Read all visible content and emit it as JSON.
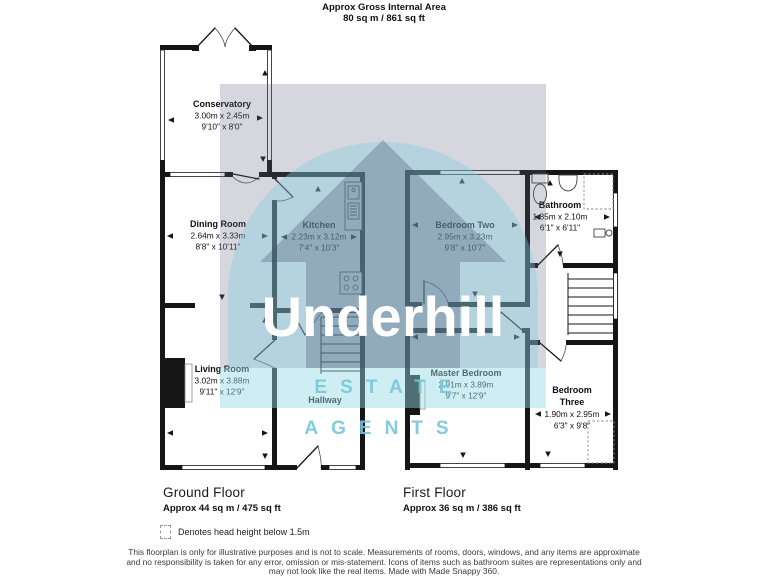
{
  "header": {
    "title": "Approx Gross Internal Area",
    "subtitle": "80 sq m / 861 sq ft"
  },
  "watermark": {
    "brand": "Underhill",
    "tagline": "ESTATE AGENTS",
    "grey": "#d5d6dd",
    "cyan": "#cdeef4",
    "band": "#d8f1f6",
    "brand_text_color": "#ffffff"
  },
  "colors": {
    "wall": "#161616",
    "background": "#ffffff"
  },
  "floors": {
    "ground": {
      "label": "Ground Floor",
      "area": "Approx 44 sq m / 475 sq ft",
      "rooms": {
        "conservatory": {
          "name": "Conservatory",
          "metric": "3.00m x 2.45m",
          "imperial": "9'10\" x 8'0\""
        },
        "dining": {
          "name": "Dining Room",
          "metric": "2.64m x 3.33m",
          "imperial": "8'8\" x 10'11\""
        },
        "kitchen": {
          "name": "Kitchen",
          "metric": "2.23m x 3.12m",
          "imperial": "7'4\" x 10'3\""
        },
        "living": {
          "name": "Living Room",
          "metric": "3.02m x 3.88m",
          "imperial": "9'11\" x 12'9\""
        },
        "hallway": {
          "name": "Hallway"
        }
      }
    },
    "first": {
      "label": "First Floor",
      "area": "Approx 36 sq m / 386 sq ft",
      "rooms": {
        "bedroom_two": {
          "name": "Bedroom Two",
          "metric": "2.95m x 3.23m",
          "imperial": "9'8\" x 10'7\""
        },
        "bathroom": {
          "name": "Bathroom",
          "metric": "1.85m x 2.10m",
          "imperial": "6'1\" x 6'11\""
        },
        "master": {
          "name": "Master Bedroom",
          "metric": "2.91m x 3.89m",
          "imperial": "9'7\" x 12'9\""
        },
        "bedroom_three": {
          "name_line1": "Bedroom",
          "name_line2": "Three",
          "metric": "1.90m x 2.95m",
          "imperial": "6'3\" x 9'8\""
        }
      }
    }
  },
  "legend": {
    "text": "Denotes head height below 1.5m"
  },
  "footer": {
    "line1": "This floorplan is only for illustrative purposes and is not to scale. Measurements of rooms, doors, windows, and any items are approximate",
    "line2": "and no responsibility is taken for any error, omission or mis-statement. Icons of items such as bathroom suites are representations only and",
    "line3": "may not look like the real items. Made with Made Snappy 360."
  }
}
